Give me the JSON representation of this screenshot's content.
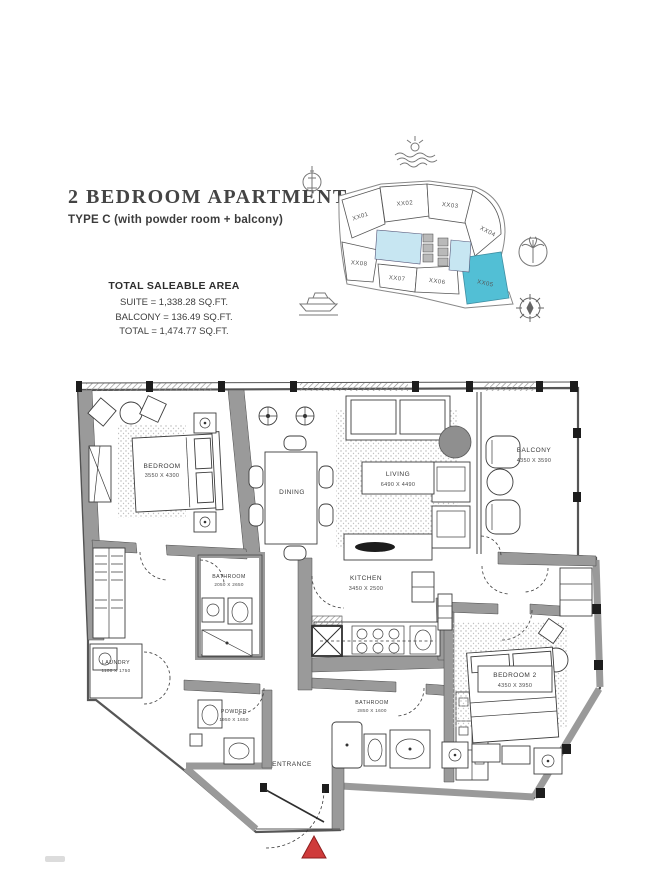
{
  "page": {
    "title": "2 BEDROOM APARTMENT",
    "subtitle": "TYPE C (with powder room + balcony)"
  },
  "area_summary": {
    "heading": "TOTAL SALEABLE AREA",
    "lines": [
      "SUITE = 1,338.28 SQ.FT.",
      "BALCONY = 136.49 SQ.FT.",
      "TOTAL = 1,474.77 SQ.FT."
    ]
  },
  "key_plan": {
    "units": [
      {
        "label": "XX01"
      },
      {
        "label": "XX02"
      },
      {
        "label": "XX03"
      },
      {
        "label": "XX04"
      },
      {
        "label": "XX05"
      },
      {
        "label": "XX06"
      },
      {
        "label": "XX07"
      },
      {
        "label": "XX08"
      }
    ],
    "highlighted_unit": "XX05",
    "icons": [
      "waves-sun-icon",
      "antenna-icon",
      "palm-tree-icon",
      "boat-icon",
      "compass-icon"
    ]
  },
  "floor_plan": {
    "rooms": [
      {
        "name": "BEDROOM",
        "dims": "3550 X 4300"
      },
      {
        "name": "DINING",
        "dims": ""
      },
      {
        "name": "LIVING",
        "dims": "6490 X 4490"
      },
      {
        "name": "BALCONY",
        "dims": "4350 X 3590"
      },
      {
        "name": "BATHROOM",
        "dims": "2050 X 2650"
      },
      {
        "name": "KITCHEN",
        "dims": "3450 X 2500"
      },
      {
        "name": "LAUNDRY",
        "dims": "1100 X 1750"
      },
      {
        "name": "POWDER",
        "dims": "1950 X 1650"
      },
      {
        "name": "BATHROOM",
        "dims": "2850 X 1600"
      },
      {
        "name": "BEDROOM 2",
        "dims": "4350 X 3950"
      },
      {
        "name": "ENTRANCE",
        "dims": ""
      }
    ],
    "entrance_marker": "entrance-triangle-marker"
  },
  "colors": {
    "unit_highlight": "#52bfd5",
    "core_fill": "#c7e6f2",
    "wall": "#9a9a9a",
    "entrance_marker": "#cf3b3b"
  }
}
